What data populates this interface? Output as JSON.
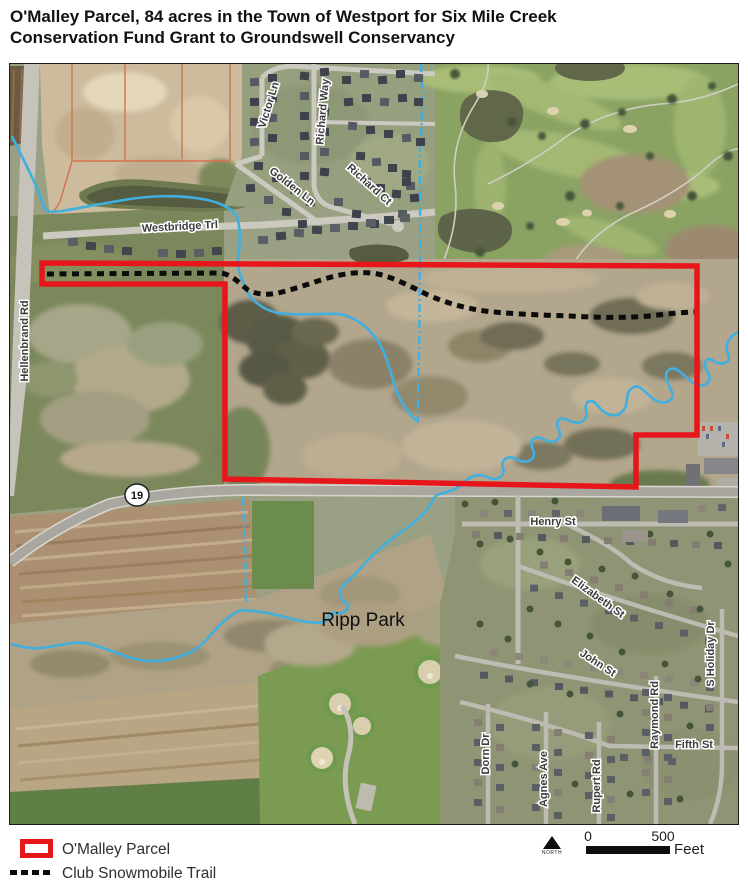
{
  "title": {
    "line1": "O'Malley Parcel, 84 acres in the Town of Westport for Six Mile Creek",
    "line2": "Conservation Fund Grant to Groundswell Conservancy"
  },
  "map": {
    "highway_shield": "19",
    "labels": {
      "hellenbrand": "Hellenbrand Rd",
      "westbridge": "Westbridge Trl",
      "victor": "Victor Ln",
      "richard_way": "Richard Way",
      "golden": "Golden Ln",
      "richard_ct": "Richard Ct",
      "henry": "Henry St",
      "elizabeth": "Elizabeth St",
      "john": "John St",
      "dorn": "Dorn Dr",
      "agnes": "Agnes Ave",
      "rupert": "Rupert Rd",
      "raymond": "Raymond Rd",
      "fifth": "Fifth St",
      "holiday": "S Holiday Dr",
      "ripp_park": "Ripp Park"
    }
  },
  "legend": {
    "parcel_label": "O'Malley Parcel",
    "trail_label": "Club Snowmobile Trail",
    "north_label": "NORTH",
    "scale_zero": "0",
    "scale_max": "500",
    "scale_unit": "Feet"
  },
  "colors": {
    "parcel_outline": "#e7161b",
    "snowmobile_trail": "#0b0b0b",
    "creek": "#3fb0e0"
  }
}
